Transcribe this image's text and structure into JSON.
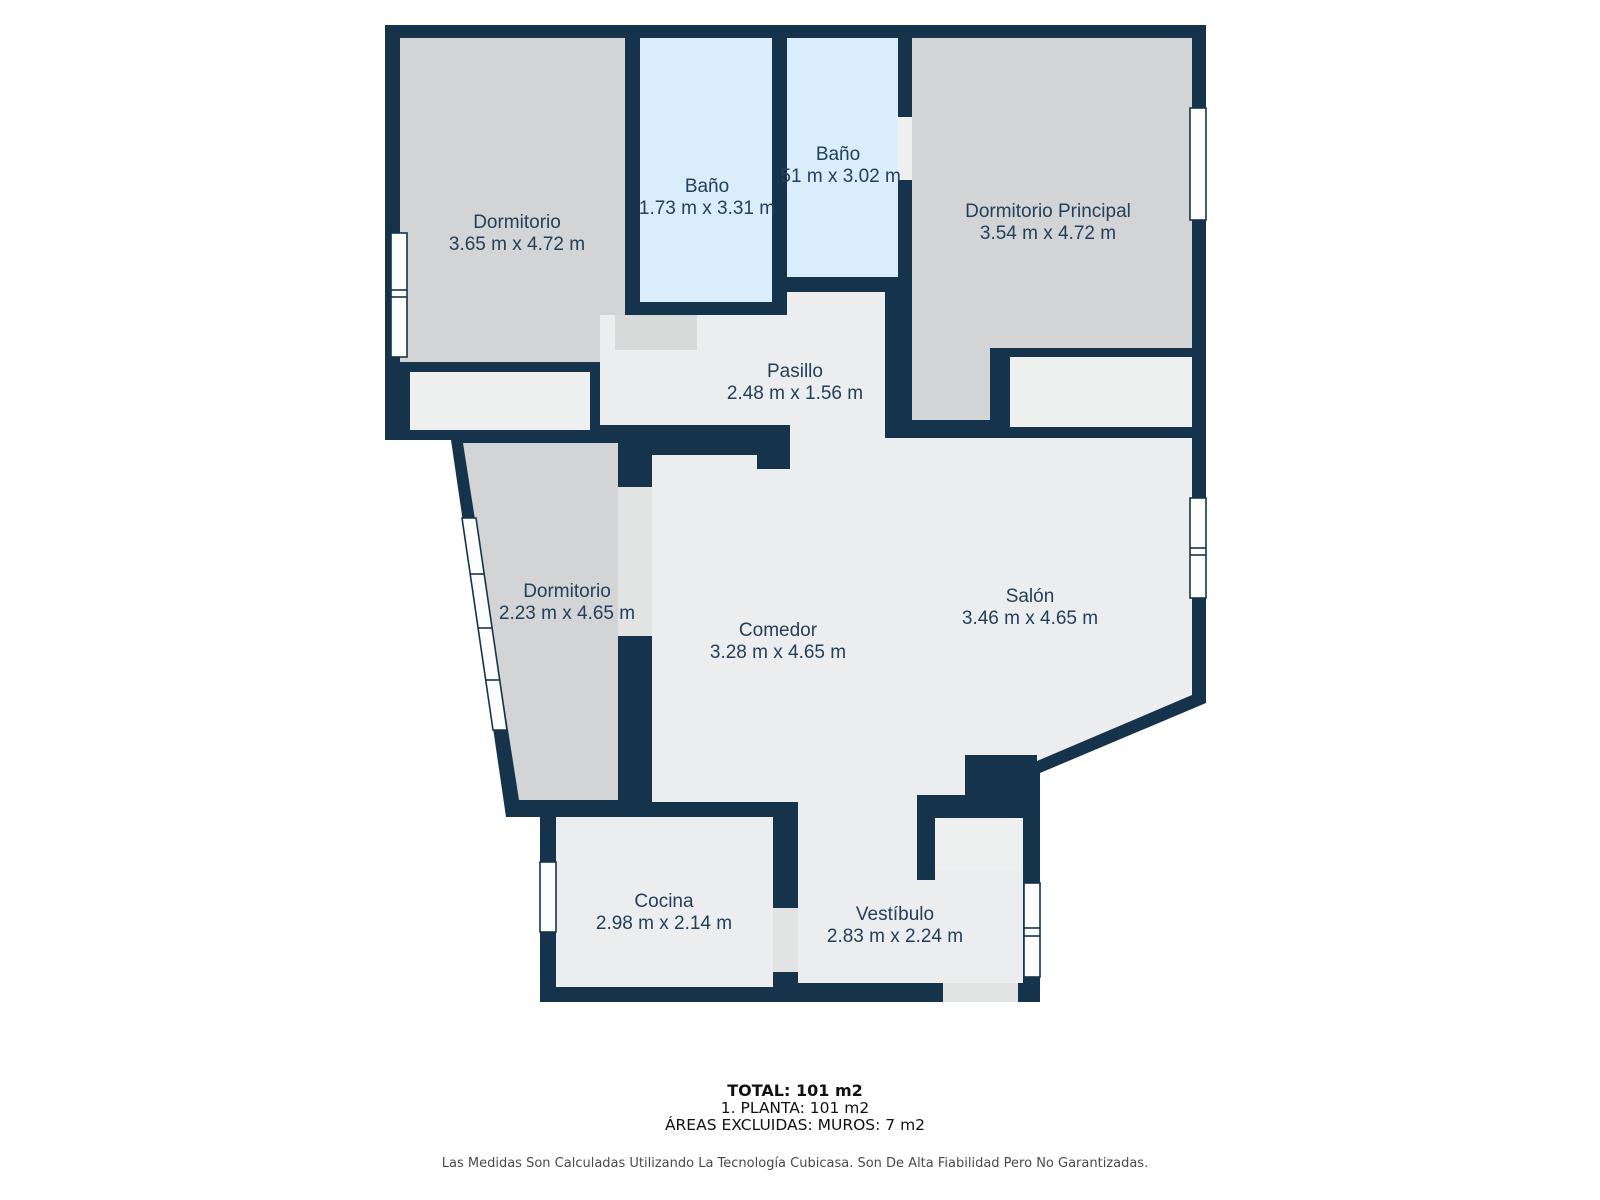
{
  "rooms": [
    {
      "id": "dormitorio-top",
      "name": "Dormitorio",
      "dims": "3.65 m x 4.72 m"
    },
    {
      "id": "bano-1",
      "name": "Baño",
      "dims": "1.73 m x 3.31 m"
    },
    {
      "id": "bano-2",
      "name": "Baño",
      "dims": ".51 m x 3.02 m"
    },
    {
      "id": "dormitorio-principal",
      "name": "Dormitorio Principal",
      "dims": "3.54 m x 4.72 m"
    },
    {
      "id": "pasillo",
      "name": "Pasillo",
      "dims": "2.48 m x 1.56 m"
    },
    {
      "id": "dormitorio-mid",
      "name": "Dormitorio",
      "dims": "2.23 m x 4.65 m"
    },
    {
      "id": "comedor",
      "name": "Comedor",
      "dims": "3.28 m x 4.65 m"
    },
    {
      "id": "salon",
      "name": "Salón",
      "dims": "3.46 m x 4.65 m"
    },
    {
      "id": "cocina",
      "name": "Cocina",
      "dims": "2.98 m x 2.14 m"
    },
    {
      "id": "vestibulo",
      "name": "Vestíbulo",
      "dims": "2.83 m x 2.24 m"
    }
  ],
  "footer": {
    "total": "TOTAL: 101 m2",
    "floor_line": "1. PLANTA: 101 m2",
    "excluded_line": "ÁREAS EXCLUIDAS: MUROS: 7 m2",
    "disclaimer": "Las Medidas Son Calculadas Utilizando La Tecnología Cubicasa. Son De Alta Fiabilidad Pero No Garantizadas."
  },
  "colors": {
    "wall_navy": "#15344b",
    "room_gray": "#d2d4d5",
    "room_light": "#ecedee",
    "bathroom_blue": "#d9edfa",
    "closet_white": "#eef0f0",
    "door_gray": "#d8dada",
    "label_text": "#22405c"
  }
}
